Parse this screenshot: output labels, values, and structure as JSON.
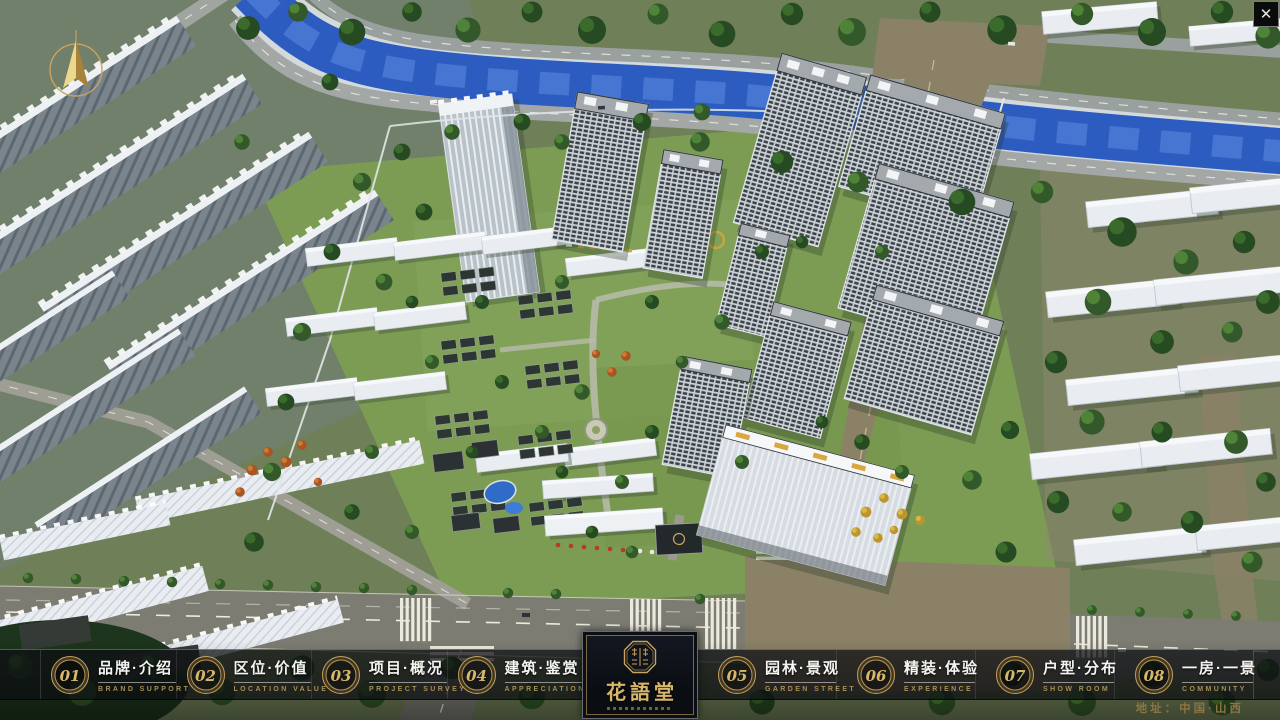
{
  "window": {
    "close_label": "✕"
  },
  "nav": {
    "items": [
      {
        "num": "01",
        "zh": "品牌·介绍",
        "en": "BRAND SUPPORT"
      },
      {
        "num": "02",
        "zh": "区位·价值",
        "en": "LOCATION VALUE"
      },
      {
        "num": "03",
        "zh": "项目·概况",
        "en": "PROJECT SURVEY"
      },
      {
        "num": "04",
        "zh": "建筑·鉴赏",
        "en": "APPRECIATION"
      },
      {
        "num": "05",
        "zh": "园林·景观",
        "en": "GARDEN STREET"
      },
      {
        "num": "06",
        "zh": "精装·体验",
        "en": "EXPERIENCE"
      },
      {
        "num": "07",
        "zh": "户型·分布",
        "en": "SHOW ROOM"
      },
      {
        "num": "08",
        "zh": "一房·一景",
        "en": "COMMUNITY"
      }
    ]
  },
  "logo": {
    "name": "花語堂"
  },
  "footer": {
    "address": "地址：中国·山西"
  },
  "colors": {
    "gold": "#c9a45e",
    "nav_bg": "rgba(12,14,18,0.72)",
    "river": "#2d5cc0"
  }
}
